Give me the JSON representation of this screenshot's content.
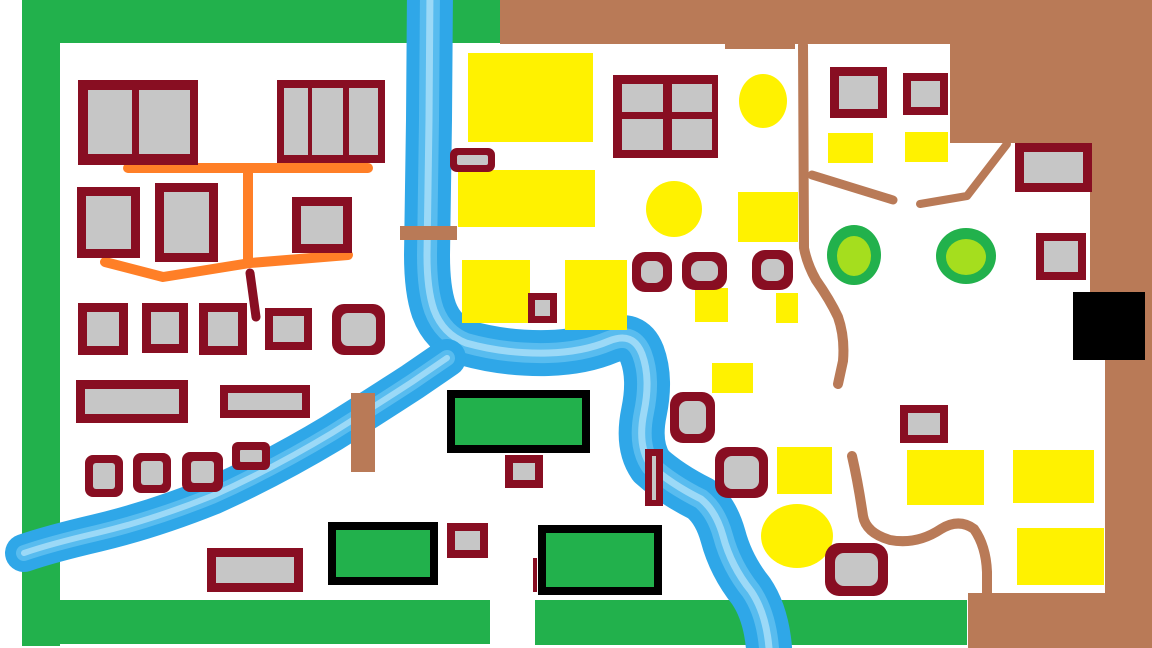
{
  "map": {
    "canvas": {
      "width": 1152,
      "height": 648,
      "background": "#FFFFFF"
    },
    "palette": {
      "green": "#22B14C",
      "lime": "#A5DE1E",
      "yellow": "#FFF200",
      "brown": "#B97A57",
      "maroon": "#880E22",
      "gray": "#C6C6C6",
      "blue": "#2FA7E8",
      "blue2": "#5FC0F0",
      "blue3": "#A3DBF7",
      "orange": "#FF7F27",
      "black": "#000000"
    },
    "shapes": [
      {
        "t": "rect",
        "name": "forest-strip-west",
        "x": 22,
        "y": 0,
        "w": 38,
        "h": 646,
        "fill": "green"
      },
      {
        "t": "rect",
        "name": "forest-strip-north",
        "x": 22,
        "y": 0,
        "w": 478,
        "h": 43,
        "fill": "green"
      },
      {
        "t": "rect",
        "name": "forest-strip-south-west",
        "x": 25,
        "y": 600,
        "w": 465,
        "h": 44,
        "fill": "green"
      },
      {
        "t": "rect",
        "name": "forest-strip-south-east",
        "x": 535,
        "y": 600,
        "w": 432,
        "h": 45,
        "fill": "green"
      },
      {
        "t": "polygon",
        "name": "mountain-region",
        "fill": "brown",
        "pts": "500,0 1152,0 1152,648 968,648 968,593 1105,593 1105,293 1090,293 1090,143 950,143 950,44 500,44"
      },
      {
        "t": "rect",
        "name": "mountain-edge-dip",
        "x": 725,
        "y": 40,
        "w": 70,
        "h": 9,
        "fill": "brown"
      },
      {
        "t": "path",
        "name": "river-main",
        "stroke": "blue",
        "sw": 46,
        "d": "M430,-10 L429,120 L427,255 Q427,290 434,310 Q443,334 466,343 Q505,354 548,353 Q583,352 609,341 Q633,331 642,354 Q651,378 644,412 Q637,446 651,466 Q671,484 701,499 Q716,511 723,536 Q731,566 751,591 Q766,613 769,648"
      },
      {
        "t": "path",
        "name": "river-main-streak-1",
        "stroke": "blue2",
        "sw": 20,
        "o": 0.85,
        "d": "M430,-10 L429,120 L427,255 Q427,290 434,310 Q443,334 466,343 Q505,354 548,353 Q583,352 609,341 Q633,331 642,354 Q651,378 644,412 Q637,446 651,466 Q671,484 701,499 Q716,511 723,536 Q731,566 751,591 Q766,613 769,648"
      },
      {
        "t": "path",
        "name": "river-main-streak-2",
        "stroke": "blue3",
        "sw": 7,
        "o": 0.9,
        "d": "M430,-10 L429,120 L427,255 Q427,290 434,310 Q443,334 466,343 Q505,354 548,353 Q583,352 609,341 Q633,331 642,354 Q651,378 644,412 Q637,446 651,466 Q671,484 701,499 Q716,511 723,536 Q731,566 751,591 Q766,613 769,648"
      },
      {
        "t": "path",
        "name": "river-west-branch",
        "stroke": "blue",
        "sw": 38,
        "d": "M447,358 L412,382 Q372,408 332,433 Q272,469 212,496 Q152,520 97,533 Q50,544 24,553"
      },
      {
        "t": "path",
        "name": "river-west-branch-streak-1",
        "stroke": "blue2",
        "sw": 16,
        "o": 0.85,
        "d": "M447,358 L412,382 Q372,408 332,433 Q272,469 212,496 Q152,520 97,533 Q50,544 24,553"
      },
      {
        "t": "path",
        "name": "river-west-branch-streak-2",
        "stroke": "blue3",
        "sw": 6,
        "o": 0.9,
        "d": "M447,358 L412,382 Q372,408 332,433 Q272,469 212,496 Q152,520 97,533 Q50,544 24,553"
      },
      {
        "t": "rect",
        "name": "bridge-north",
        "x": 400,
        "y": 226,
        "w": 57,
        "h": 14,
        "fill": "brown"
      },
      {
        "t": "rect",
        "name": "bridge-west",
        "x": 351,
        "y": 393,
        "w": 24,
        "h": 79,
        "fill": "brown"
      },
      {
        "t": "path",
        "name": "road-village-main",
        "stroke": "orange",
        "sw": 10,
        "d": "M128,168 L368,168"
      },
      {
        "t": "path",
        "name": "road-village-cross",
        "stroke": "orange",
        "sw": 10,
        "d": "M248,171 L248,261"
      },
      {
        "t": "path",
        "name": "road-village-south",
        "stroke": "orange",
        "sw": 10,
        "d": "M105,262 L163,277 L250,263 L348,255"
      },
      {
        "t": "path",
        "name": "road-village-stub",
        "stroke": "maroon",
        "sw": 9,
        "d": "M250,273 L256,317"
      },
      {
        "t": "path",
        "name": "trail-east-1",
        "stroke": "brown",
        "sw": 10,
        "d": "M803,45 L804,248 Q807,264 816,280 Q830,300 838,317 Q845,337 843,361 L838,384"
      },
      {
        "t": "path",
        "name": "trail-east-2",
        "stroke": "brown",
        "sw": 9,
        "d": "M812,175 L893,200"
      },
      {
        "t": "path",
        "name": "trail-east-3",
        "stroke": "brown",
        "sw": 8,
        "d": "M920,204 L967,196 L1007,144"
      },
      {
        "t": "path",
        "name": "trail-east-4",
        "stroke": "brown",
        "sw": 10,
        "d": "M852,456 Q858,482 863,516 Q866,533 890,540 Q917,545 941,529 Q959,518 974,529 Q986,546 987,572 L987,594"
      },
      {
        "t": "rect",
        "name": "field-1",
        "x": 468,
        "y": 53,
        "w": 125,
        "h": 89,
        "fill": "yellow"
      },
      {
        "t": "rect",
        "name": "field-2",
        "x": 458,
        "y": 170,
        "w": 137,
        "h": 57,
        "fill": "yellow"
      },
      {
        "t": "rect",
        "name": "field-3",
        "x": 462,
        "y": 260,
        "w": 68,
        "h": 63,
        "fill": "yellow"
      },
      {
        "t": "rect",
        "name": "field-4",
        "x": 565,
        "y": 260,
        "w": 62,
        "h": 70,
        "fill": "yellow"
      },
      {
        "t": "rect",
        "name": "field-5",
        "x": 738,
        "y": 192,
        "w": 60,
        "h": 50,
        "fill": "yellow"
      },
      {
        "t": "rect",
        "name": "field-6",
        "x": 695,
        "y": 288,
        "w": 33,
        "h": 34,
        "fill": "yellow"
      },
      {
        "t": "rect",
        "name": "field-7",
        "x": 776,
        "y": 293,
        "w": 22,
        "h": 30,
        "fill": "yellow"
      },
      {
        "t": "rect",
        "name": "field-8",
        "x": 712,
        "y": 363,
        "w": 41,
        "h": 30,
        "fill": "yellow"
      },
      {
        "t": "rect",
        "name": "field-9",
        "x": 828,
        "y": 133,
        "w": 45,
        "h": 30,
        "fill": "yellow"
      },
      {
        "t": "rect",
        "name": "field-10",
        "x": 905,
        "y": 132,
        "w": 43,
        "h": 30,
        "fill": "yellow"
      },
      {
        "t": "rect",
        "name": "field-11",
        "x": 777,
        "y": 447,
        "w": 55,
        "h": 47,
        "fill": "yellow"
      },
      {
        "t": "rect",
        "name": "field-12",
        "x": 907,
        "y": 450,
        "w": 77,
        "h": 55,
        "fill": "yellow"
      },
      {
        "t": "rect",
        "name": "field-13",
        "x": 1013,
        "y": 450,
        "w": 81,
        "h": 53,
        "fill": "yellow"
      },
      {
        "t": "rect",
        "name": "field-14",
        "x": 1017,
        "y": 528,
        "w": 87,
        "h": 57,
        "fill": "yellow"
      },
      {
        "t": "ellipse",
        "name": "field-circle-1",
        "cx": 763,
        "cy": 101,
        "rx": 24,
        "ry": 27,
        "fill": "yellow"
      },
      {
        "t": "ellipse",
        "name": "field-circle-2",
        "cx": 674,
        "cy": 209,
        "rx": 28,
        "ry": 28,
        "fill": "yellow"
      },
      {
        "t": "ellipse",
        "name": "field-circle-3",
        "cx": 797,
        "cy": 536,
        "rx": 36,
        "ry": 32,
        "fill": "yellow"
      },
      {
        "t": "ellipse",
        "name": "tree-1-ring",
        "cx": 854,
        "cy": 255,
        "rx": 27,
        "ry": 30,
        "fill": "green"
      },
      {
        "t": "ellipse",
        "name": "tree-1-fill",
        "cx": 854,
        "cy": 256,
        "rx": 17,
        "ry": 20,
        "fill": "lime"
      },
      {
        "t": "ellipse",
        "name": "tree-2-ring",
        "cx": 966,
        "cy": 256,
        "rx": 30,
        "ry": 28,
        "fill": "green"
      },
      {
        "t": "ellipse",
        "name": "tree-2-fill",
        "cx": 966,
        "cy": 257,
        "rx": 20,
        "ry": 18,
        "fill": "lime"
      },
      {
        "t": "rect",
        "name": "mine-entrance",
        "x": 1073,
        "y": 292,
        "w": 72,
        "h": 68,
        "fill": "black"
      },
      {
        "t": "building",
        "name": "house-01",
        "x": 78,
        "y": 80,
        "w": 120,
        "h": 85,
        "bw": 8,
        "panes": [
          [
            88,
            90,
            44,
            64
          ],
          [
            139,
            90,
            51,
            64
          ]
        ]
      },
      {
        "t": "building",
        "name": "house-02",
        "x": 277,
        "y": 80,
        "w": 108,
        "h": 83,
        "bw": 7,
        "panes": [
          [
            284,
            88,
            24,
            67
          ],
          [
            312,
            88,
            31,
            67
          ],
          [
            349,
            88,
            29,
            67
          ]
        ]
      },
      {
        "t": "building",
        "name": "house-03",
        "x": 77,
        "y": 187,
        "w": 63,
        "h": 71,
        "bw": 9,
        "panes": "auto"
      },
      {
        "t": "building",
        "name": "house-04",
        "x": 155,
        "y": 183,
        "w": 63,
        "h": 79,
        "bw": 9,
        "panes": "auto"
      },
      {
        "t": "building",
        "name": "house-05",
        "x": 292,
        "y": 197,
        "w": 60,
        "h": 56,
        "bw": 9,
        "panes": "auto"
      },
      {
        "t": "building",
        "name": "house-06",
        "x": 78,
        "y": 303,
        "w": 50,
        "h": 52,
        "bw": 9,
        "panes": "auto"
      },
      {
        "t": "building",
        "name": "house-07",
        "x": 142,
        "y": 303,
        "w": 46,
        "h": 50,
        "bw": 9,
        "panes": "auto"
      },
      {
        "t": "building",
        "name": "house-08",
        "x": 199,
        "y": 303,
        "w": 48,
        "h": 52,
        "bw": 9,
        "panes": "auto"
      },
      {
        "t": "building",
        "name": "house-09",
        "x": 265,
        "y": 308,
        "w": 47,
        "h": 42,
        "bw": 8,
        "panes": "auto"
      },
      {
        "t": "building",
        "name": "house-10",
        "x": 332,
        "y": 304,
        "w": 53,
        "h": 51,
        "bw": 9,
        "r": 12,
        "panes": "auto"
      },
      {
        "t": "building",
        "name": "hall-11",
        "x": 76,
        "y": 380,
        "w": 112,
        "h": 43,
        "bw": 9,
        "panes": "auto"
      },
      {
        "t": "building",
        "name": "hall-12",
        "x": 220,
        "y": 385,
        "w": 90,
        "h": 33,
        "bw": 8,
        "panes": "auto"
      },
      {
        "t": "building",
        "name": "house-13",
        "x": 85,
        "y": 455,
        "w": 38,
        "h": 42,
        "bw": 8,
        "r": 8,
        "panes": "auto"
      },
      {
        "t": "building",
        "name": "house-14",
        "x": 133,
        "y": 453,
        "w": 38,
        "h": 40,
        "bw": 8,
        "r": 8,
        "panes": "auto"
      },
      {
        "t": "building",
        "name": "house-15",
        "x": 182,
        "y": 452,
        "w": 41,
        "h": 40,
        "bw": 9,
        "r": 8,
        "panes": "auto"
      },
      {
        "t": "building",
        "name": "house-16",
        "x": 232,
        "y": 442,
        "w": 38,
        "h": 28,
        "bw": 8,
        "r": 6,
        "panes": "auto"
      },
      {
        "t": "building",
        "name": "hall-17",
        "x": 207,
        "y": 548,
        "w": 96,
        "h": 44,
        "bw": 9,
        "panes": "auto"
      },
      {
        "t": "building",
        "name": "shed-18",
        "x": 450,
        "y": 148,
        "w": 45,
        "h": 24,
        "bw": 7,
        "r": 7,
        "panes": "auto"
      },
      {
        "t": "building",
        "name": "manor-19",
        "x": 613,
        "y": 75,
        "w": 105,
        "h": 83,
        "bw": 9,
        "panes": [
          [
            622,
            84,
            41,
            28
          ],
          [
            672,
            84,
            40,
            28
          ],
          [
            622,
            119,
            41,
            31
          ],
          [
            672,
            119,
            40,
            31
          ]
        ]
      },
      {
        "t": "building",
        "name": "shed-20",
        "x": 528,
        "y": 293,
        "w": 29,
        "h": 30,
        "bw": 7,
        "panes": "auto"
      },
      {
        "t": "building",
        "name": "house-21",
        "x": 632,
        "y": 252,
        "w": 40,
        "h": 40,
        "bw": 9,
        "r": 13,
        "panes": "auto"
      },
      {
        "t": "building",
        "name": "house-22",
        "x": 682,
        "y": 252,
        "w": 45,
        "h": 38,
        "bw": 9,
        "r": 13,
        "panes": "auto"
      },
      {
        "t": "building",
        "name": "house-23",
        "x": 752,
        "y": 250,
        "w": 41,
        "h": 40,
        "bw": 9,
        "r": 13,
        "panes": "auto"
      },
      {
        "t": "building",
        "name": "house-24",
        "x": 670,
        "y": 392,
        "w": 45,
        "h": 51,
        "bw": 9,
        "r": 13,
        "panes": "auto"
      },
      {
        "t": "building",
        "name": "lock-25",
        "x": 645,
        "y": 449,
        "w": 18,
        "h": 57,
        "bw": 0,
        "panes": [
          [
            652,
            456,
            4,
            44
          ]
        ]
      },
      {
        "t": "building",
        "name": "house-26",
        "x": 715,
        "y": 447,
        "w": 53,
        "h": 51,
        "bw": 9,
        "r": 13,
        "panes": "auto"
      },
      {
        "t": "building",
        "name": "house-27",
        "x": 825,
        "y": 543,
        "w": 63,
        "h": 53,
        "bw": 10,
        "r": 14,
        "panes": "auto"
      },
      {
        "t": "building",
        "name": "shed-28",
        "x": 505,
        "y": 455,
        "w": 38,
        "h": 33,
        "bw": 8,
        "panes": "auto"
      },
      {
        "t": "building",
        "name": "shed-29",
        "x": 447,
        "y": 523,
        "w": 41,
        "h": 35,
        "bw": 8,
        "panes": "auto"
      },
      {
        "t": "building",
        "name": "house-30",
        "x": 830,
        "y": 67,
        "w": 57,
        "h": 51,
        "bw": 9,
        "panes": "auto"
      },
      {
        "t": "building",
        "name": "house-31",
        "x": 903,
        "y": 73,
        "w": 45,
        "h": 42,
        "bw": 8,
        "panes": "auto"
      },
      {
        "t": "building",
        "name": "house-32",
        "x": 1015,
        "y": 143,
        "w": 77,
        "h": 49,
        "bw": 9,
        "panes": "auto"
      },
      {
        "t": "building",
        "name": "house-33",
        "x": 1036,
        "y": 233,
        "w": 50,
        "h": 47,
        "bw": 8,
        "panes": "auto"
      },
      {
        "t": "building",
        "name": "house-34",
        "x": 900,
        "y": 405,
        "w": 48,
        "h": 38,
        "bw": 8,
        "panes": "auto"
      },
      {
        "t": "building",
        "name": "pasture-1",
        "x": 447,
        "y": 390,
        "w": 143,
        "h": 63,
        "bw": 8,
        "border": "black",
        "fill": "green",
        "panes": "auto"
      },
      {
        "t": "building",
        "name": "pasture-2",
        "x": 328,
        "y": 522,
        "w": 110,
        "h": 63,
        "bw": 8,
        "border": "black",
        "fill": "green",
        "panes": "auto"
      },
      {
        "t": "building",
        "name": "pasture-3",
        "x": 538,
        "y": 525,
        "w": 124,
        "h": 70,
        "bw": 8,
        "border": "black",
        "fill": "green",
        "panes": "auto"
      },
      {
        "t": "rect",
        "name": "boundary-mark",
        "x": 533,
        "y": 558,
        "w": 4,
        "h": 34,
        "fill": "maroon"
      }
    ]
  }
}
